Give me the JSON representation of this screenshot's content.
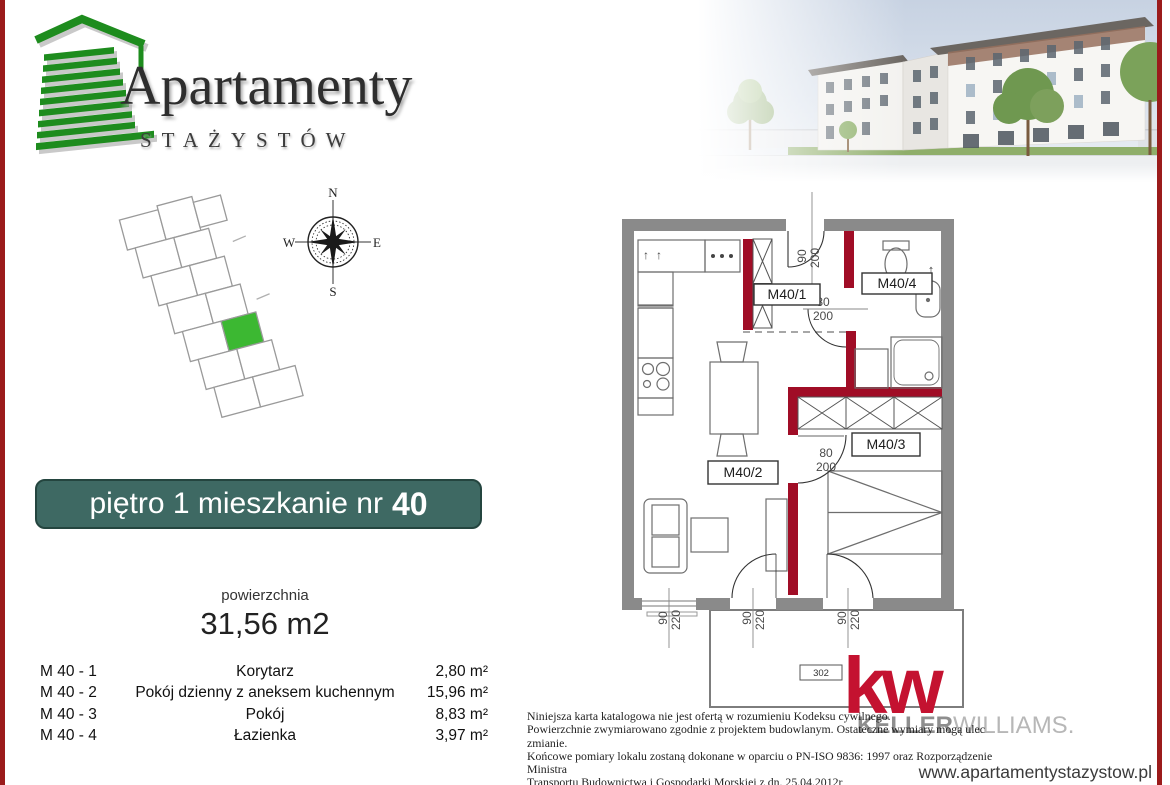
{
  "page": {
    "url_label": "www.apartamentystazystow.pl"
  },
  "logo": {
    "title": "Apartamenty",
    "subtitle": "STAŻYSTÓW"
  },
  "banner": {
    "prefix": "piętro 1 mieszkanie nr",
    "number": "40"
  },
  "area": {
    "label": "powierzchnia",
    "value": "31,56 m2"
  },
  "rooms": [
    {
      "code": "M 40 - 1",
      "name": "Korytarz",
      "area": "2,80 m²"
    },
    {
      "code": "M 40 - 2",
      "name": "Pokój dzienny z aneksem kuchennym",
      "area": "15,96 m²"
    },
    {
      "code": "M 40 - 3",
      "name": "Pokój",
      "area": "8,83 m²"
    },
    {
      "code": "M 40 - 4",
      "name": "Łazienka",
      "area": "3,97 m²"
    }
  ],
  "compass": {
    "n": "N",
    "e": "E",
    "s": "S",
    "w": "W"
  },
  "floorplan": {
    "labels": {
      "m1": "M40/1",
      "m2": "M40/2",
      "m3": "M40/3",
      "m4": "M40/4",
      "balcony": "302"
    },
    "dims": {
      "entry_w": "90",
      "entry_h": "200",
      "bath_w": "80",
      "bath_h": "200",
      "room_w": "80",
      "room_h": "200",
      "win1_w": "90",
      "win1_h": "220",
      "win2_w": "90",
      "win2_h": "220",
      "win3_w": "90",
      "win3_h": "220"
    }
  },
  "icons": {
    "up_arrow": "↑"
  },
  "brand": {
    "mark": "kw",
    "name_bold": "KELLER",
    "name_light": "WILLIAMS.",
    "red": "#c41230"
  },
  "disclaimer": {
    "line1": "Niniejsza karta katalogowa nie jest ofertą w rozumieniu Kodeksu cywilnego.",
    "line2": "Powierzchnie zwymiarowano zgodnie z projektem budowlanym. Ostateczne wymiary mogą ulec zmianie.",
    "line3": "Końcowe pomiary lokalu zostaną dokonane w oparciu o PN-ISO 9836: 1997 oraz Rozporządzenie Ministra",
    "line4": "Transportu Budownictwa i Gospodarki Morskiej z dn. 25.04.2012r"
  },
  "colors": {
    "accent_red": "#9b1b1b",
    "plan_red": "#a00d26",
    "banner_teal": "#3e6963",
    "logo_green": "#1e8c1e",
    "kw_red": "#c41230",
    "wall_gray": "#8a8a8a"
  }
}
